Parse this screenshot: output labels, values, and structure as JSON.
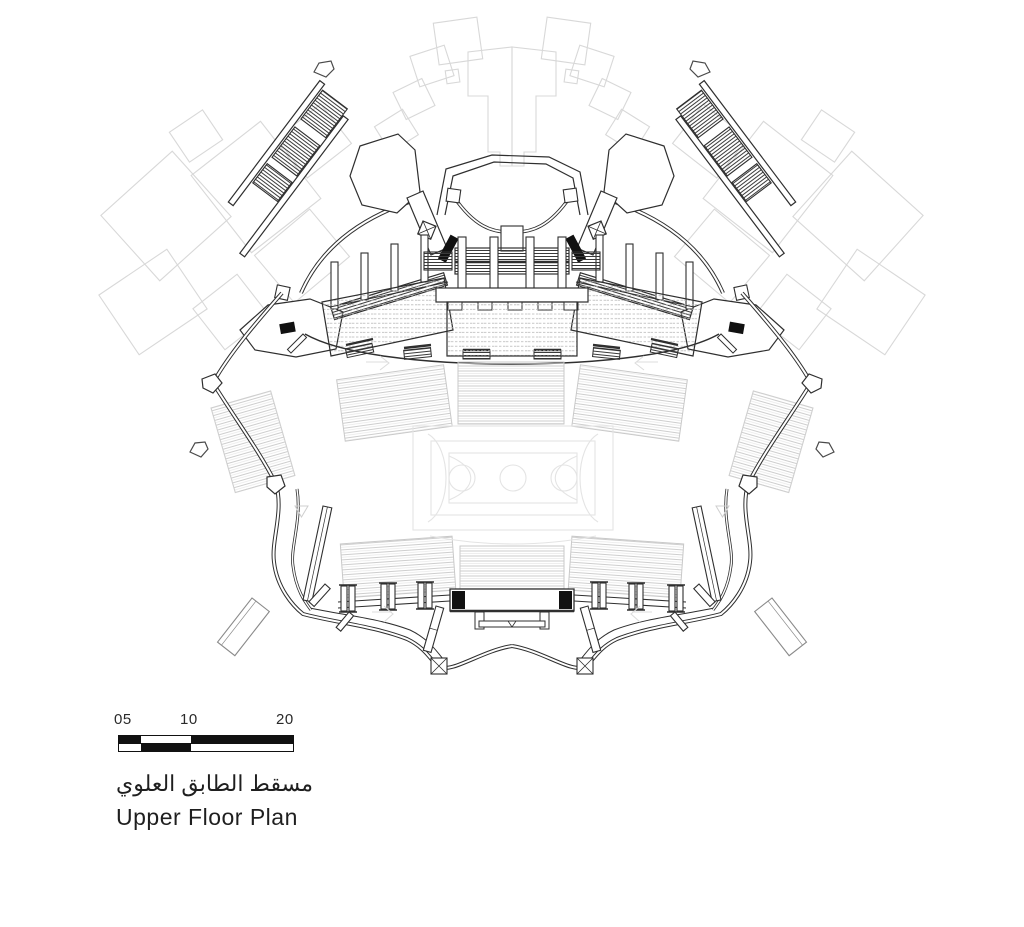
{
  "plan": {
    "title_ar": "مسقط الطابق العلوي",
    "title_en": "Upper Floor Plan"
  },
  "scalebar": {
    "labels": [
      "05",
      "10",
      "20"
    ]
  },
  "colors": {
    "ink": "#2f2f2f",
    "black_fill": "#111111",
    "context_outline": "#d8d8d8",
    "faint_court": "#e4e4e4",
    "seat_rows": "#c9c9c9",
    "paper": "#ffffff"
  }
}
